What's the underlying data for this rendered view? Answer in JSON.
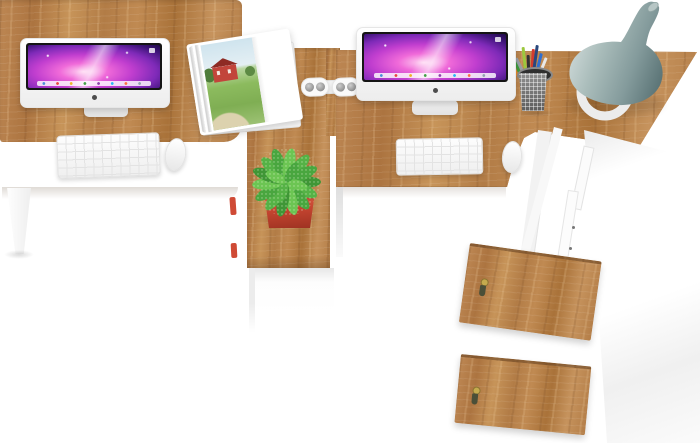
{
  "scene": {
    "title": "Two-seat office workstation set with hutch, overhead product photo",
    "background_color": "#ffffff",
    "workstation_count": 2,
    "objects": {
      "desk_left": "oak desktop of left workstation",
      "desk_right": "oak desktop of right workstation",
      "center_pedestal": "oak center pedestal with white cabinet base",
      "side_cabinet": "tall white side cabinet",
      "door_top": "upper oak cabinet door with brass key",
      "door_bottom": "lower oak cabinet door with brass key",
      "key": "brass key with olive tassel in door lock",
      "imac_left": "white all-in-one computer with purple nebula wallpaper and dock",
      "imac_right": "white all-in-one computer with purple nebula wallpaper and dock",
      "keyboard_left": "white wireless keyboard",
      "keyboard_right": "white wireless keyboard",
      "mouse_left": "white mouse",
      "mouse_right": "white mouse",
      "magazine": "open magazine showing red farmhouse landscape photo",
      "power_strip": "white twin-pill power strip with four sockets",
      "pencil_cup": "grey wire-mesh cup holding colored pens and pencils",
      "plant": "speckled green plant in red square pot on pedestal",
      "vase": "grey-blue bottle vase on white ring stand at desk corner",
      "desk_leg_left": "white tapered desk leg",
      "junction_legs": "white support panels at right desk junction",
      "red_accents": "small red object edges behind center pedestal"
    },
    "pen_colors": [
      "#3e9c3c",
      "#9cc83e",
      "#d23c2e",
      "#2f6fd0",
      "#333333",
      "#9aa0a6",
      "#e8e8e8",
      "#29487d",
      "#e98a2b"
    ],
    "dock_icon_colors": [
      "#4a90d9",
      "#e8483f",
      "#f0b429",
      "#43a047",
      "#8e44ad",
      "#29b6f6",
      "#ff7043",
      "#90a4ae"
    ]
  },
  "palette": {
    "wood": "#b8824e",
    "wood_light": "#c79459",
    "wood_dark": "#8f6136",
    "white_furniture": "#f5f5f5",
    "screen_bezel": "#151515",
    "wallpaper_magenta": "#f06ad9",
    "wallpaper_deep_purple": "#1f0a47",
    "plant_green": "#55b246",
    "pot_red": "#c44430",
    "vase_gray_blue": "#849b9c",
    "key_brass": "#c4aa4e",
    "tassel_olive": "#4a4f38",
    "barn_red": "#c2453b",
    "field_green": "#8cbb5e",
    "sky_blue": "#cfe4ee"
  }
}
